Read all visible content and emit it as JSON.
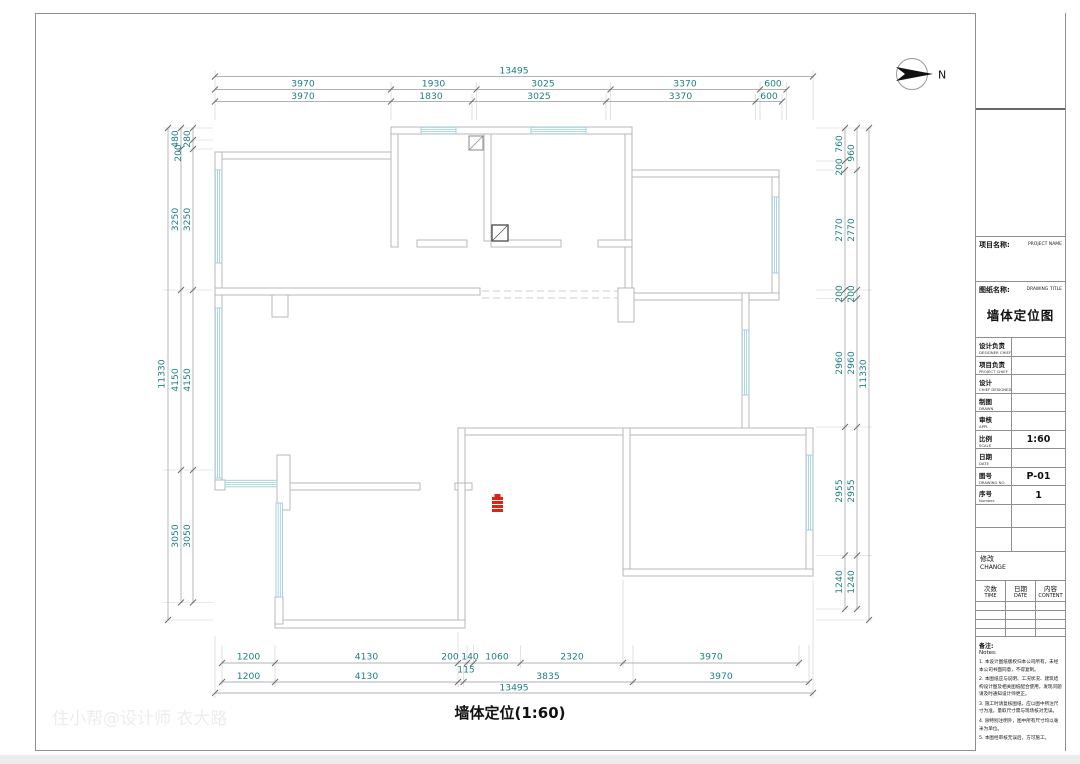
{
  "sheet": {
    "plan_title": "墙体定位(1:60)",
    "north_label": "N",
    "watermark": "住小帮@设计师 衣大路"
  },
  "dimensions": {
    "top": {
      "total": "13495",
      "row1": [
        "3970",
        "1930",
        "3025",
        "3370",
        "600"
      ],
      "row2": [
        "3970",
        "1830",
        "3025",
        "3370",
        "600"
      ]
    },
    "bottom": {
      "row1": [
        "1200",
        "4130",
        "200",
        "140",
        "1060",
        "2320",
        "3970"
      ],
      "row1_sub": "115",
      "row2": [
        "1200",
        "4130",
        "3835",
        "3970"
      ],
      "total": "13495"
    },
    "left": {
      "total": "11330",
      "chain_a": [
        "480",
        "3250",
        "4150",
        "3050"
      ],
      "chain_b": [
        "280",
        "200",
        "3250",
        "4150",
        "3050"
      ]
    },
    "right": {
      "total": "11330",
      "chain_a": [
        "760",
        "200",
        "2770",
        "200",
        "2960",
        "2955",
        "1240"
      ],
      "chain_b": [
        "960",
        "2770",
        "200",
        "2960",
        "2955",
        "1240"
      ]
    }
  },
  "title_block": {
    "project_label_cn": "项目名称:",
    "project_label_en": "PROJECT NAME",
    "drawing_label_cn": "图纸名称:",
    "drawing_label_en": "DRAWING TITLE",
    "drawing_title": "墙体定位图",
    "rows": [
      {
        "cn": "设计负责",
        "en": "DESIGNER CHIEF",
        "value": ""
      },
      {
        "cn": "项目负责",
        "en": "PROJECT CHIEF",
        "value": ""
      },
      {
        "cn": "设计",
        "en": "CHIEF DESIGNED",
        "value": ""
      },
      {
        "cn": "制图",
        "en": "DRAWN",
        "value": ""
      },
      {
        "cn": "审核",
        "en": "APPL",
        "value": ""
      },
      {
        "cn": "比例",
        "en": "SCALE",
        "value": "1:60"
      },
      {
        "cn": "日期",
        "en": "DATE",
        "value": ""
      },
      {
        "cn": "图号",
        "en": "DRAWING NO.",
        "value": "P-01"
      },
      {
        "cn": "序号",
        "en": "Number.",
        "value": "1"
      }
    ],
    "change_cn": "修改",
    "change_en": "CHANGE",
    "change_cols": [
      {
        "cn": "次数",
        "en": "TIME"
      },
      {
        "cn": "日期",
        "en": "DATE"
      },
      {
        "cn": "内容",
        "en": "CONTENT"
      }
    ],
    "notes_label_cn": "备注:",
    "notes_label_en": "Notes:",
    "notes": [
      "1. 本设计图纸版权归本公司所有，未经本公司书面同意，不得复制。",
      "2. 本图纸应与说明、工况状况、建筑结构设计图及相关图纸配合使用，发现问题请及时通知设计师更正。",
      "3. 施工时请复核图纸，应以图中所注尺寸为准，量取尺寸需与现场核对无误。",
      "4. 除特别注明外，图中所有尺寸均以毫米为单位。",
      "5. 本图经审核无误后，方可施工。"
    ]
  },
  "colors": {
    "dimension_text": "#1f7f80",
    "wall_line": "#b3b3b3",
    "window_line": "#9ccedd",
    "marker_red": "#e32119"
  }
}
